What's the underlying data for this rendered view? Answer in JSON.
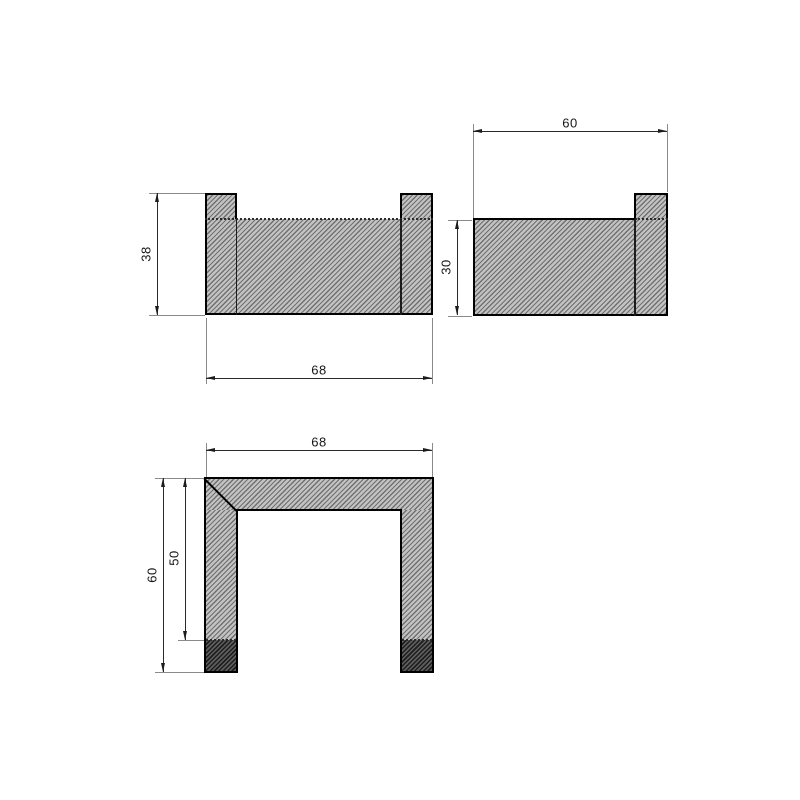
{
  "page": {
    "type": "technical-drawing",
    "background": "#ffffff",
    "description": "Three-view CAD section drawing of a U-shaped bracket / double hook"
  },
  "colors": {
    "outline": "#000000",
    "hatch_line": "#707070",
    "hatch_background": "#c2c2c2",
    "hatch_dark_line": "#1e1e1e",
    "hatch_dark_background": "#5e5e5e",
    "dimension_line": "#2a2a2a",
    "extension_line": "#8a8a8a",
    "text": "#161616"
  },
  "views": {
    "front": {
      "name": "front-view",
      "height_label": "38",
      "width_label": "68"
    },
    "side": {
      "name": "side-view",
      "width_label": "60",
      "height_label": "30"
    },
    "top": {
      "name": "top-view",
      "width_label": "68",
      "outer_depth_label": "60",
      "inner_depth_label": "50"
    }
  }
}
